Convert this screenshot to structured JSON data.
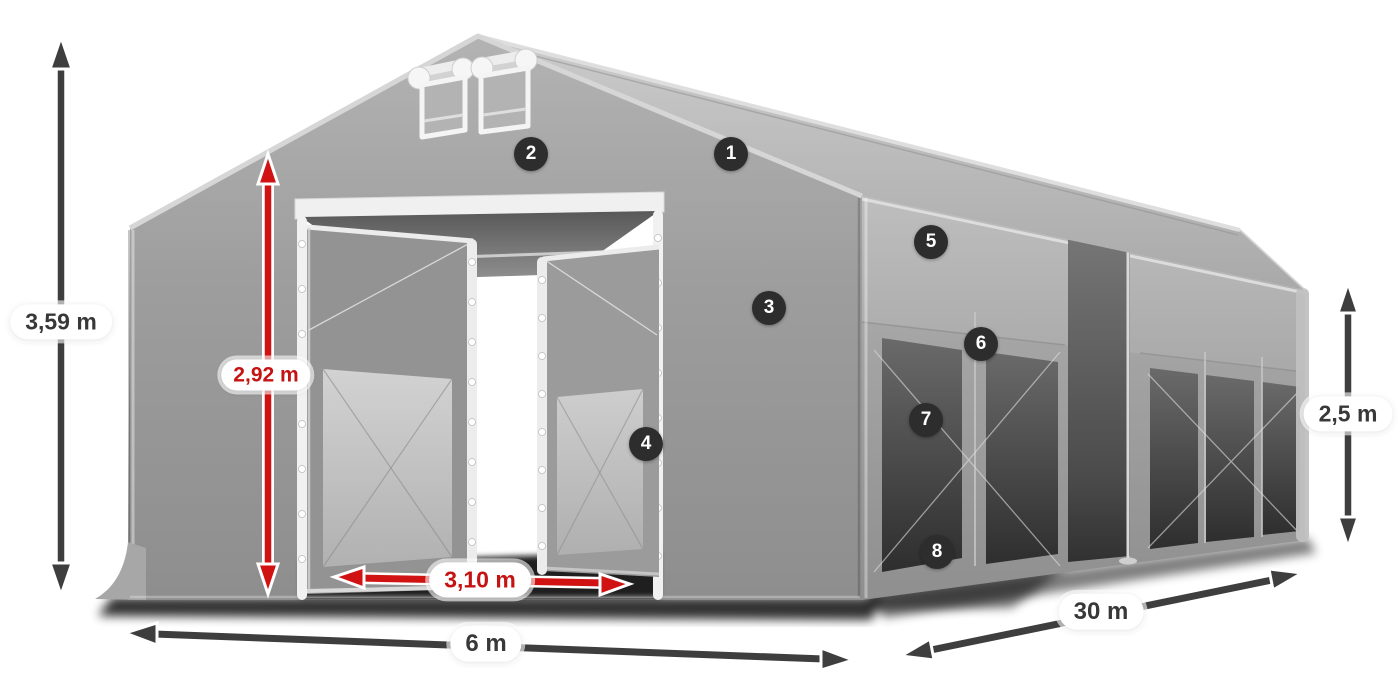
{
  "diagram": {
    "background": "#ffffff",
    "colors": {
      "tent_body": "#9c9c9c",
      "tent_roof": "#bdbdbd",
      "interior_dark": "#3b3b3b",
      "dimension_red": "#c51313",
      "dimension_dark": "#3e3e3e",
      "pill_background": "#ffffff",
      "badge_background": "#2d2d2d",
      "badge_text": "#ffffff"
    },
    "dimensions": {
      "total_height": {
        "label": "3,59 m",
        "style": "dark"
      },
      "entrance_height": {
        "label": "2,92 m",
        "style": "red"
      },
      "entrance_width": {
        "label": "3,10 m",
        "style": "red"
      },
      "gable_width": {
        "label": "6 m",
        "style": "dark"
      },
      "length": {
        "label": "30 m",
        "style": "dark"
      },
      "side_wall_height": {
        "label": "2,5 m",
        "style": "dark"
      }
    },
    "callouts": [
      {
        "number": "1"
      },
      {
        "number": "2"
      },
      {
        "number": "3"
      },
      {
        "number": "4"
      },
      {
        "number": "5"
      },
      {
        "number": "6"
      },
      {
        "number": "7"
      },
      {
        "number": "8"
      }
    ]
  }
}
